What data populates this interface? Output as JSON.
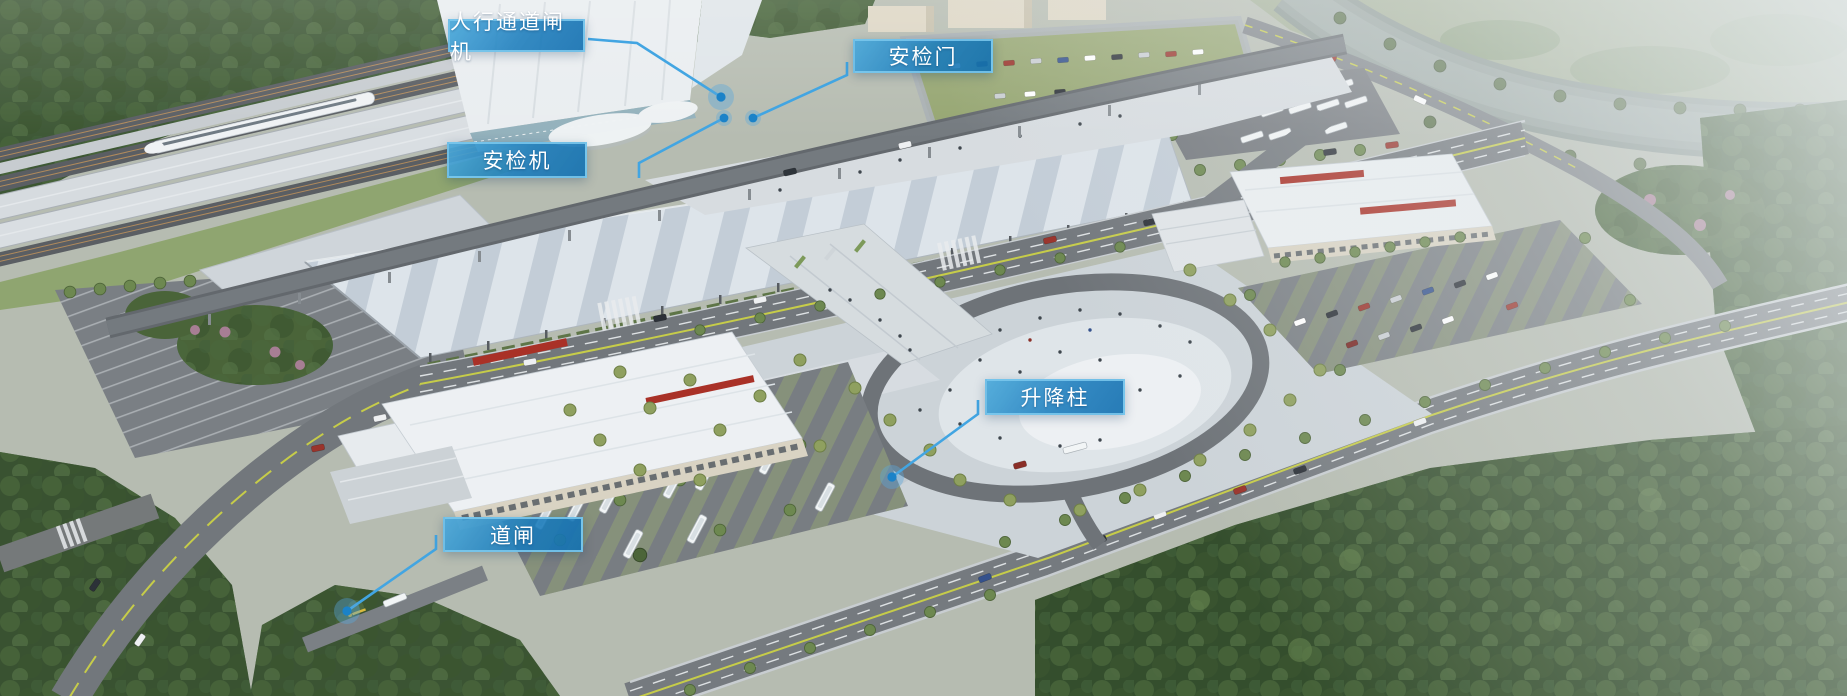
{
  "canvas": {
    "width": 1847,
    "height": 696
  },
  "annotations": {
    "colors": {
      "label_background": "#1b86c2",
      "label_border": "#7ecaef",
      "label_text": "#ffffff",
      "leader_line": "#42a5e2",
      "marker_dot": "#1b82c8",
      "marker_halo": "rgba(90,168,220,0.40)"
    },
    "labels": [
      {
        "id": "pedestrian-gate",
        "text": "人行通道闸机"
      },
      {
        "id": "security-door",
        "text": "安检门"
      },
      {
        "id": "security-scanner",
        "text": "安检机"
      },
      {
        "id": "lift-bollard",
        "text": "升降柱"
      },
      {
        "id": "barrier-gate",
        "text": "道闸"
      }
    ]
  }
}
